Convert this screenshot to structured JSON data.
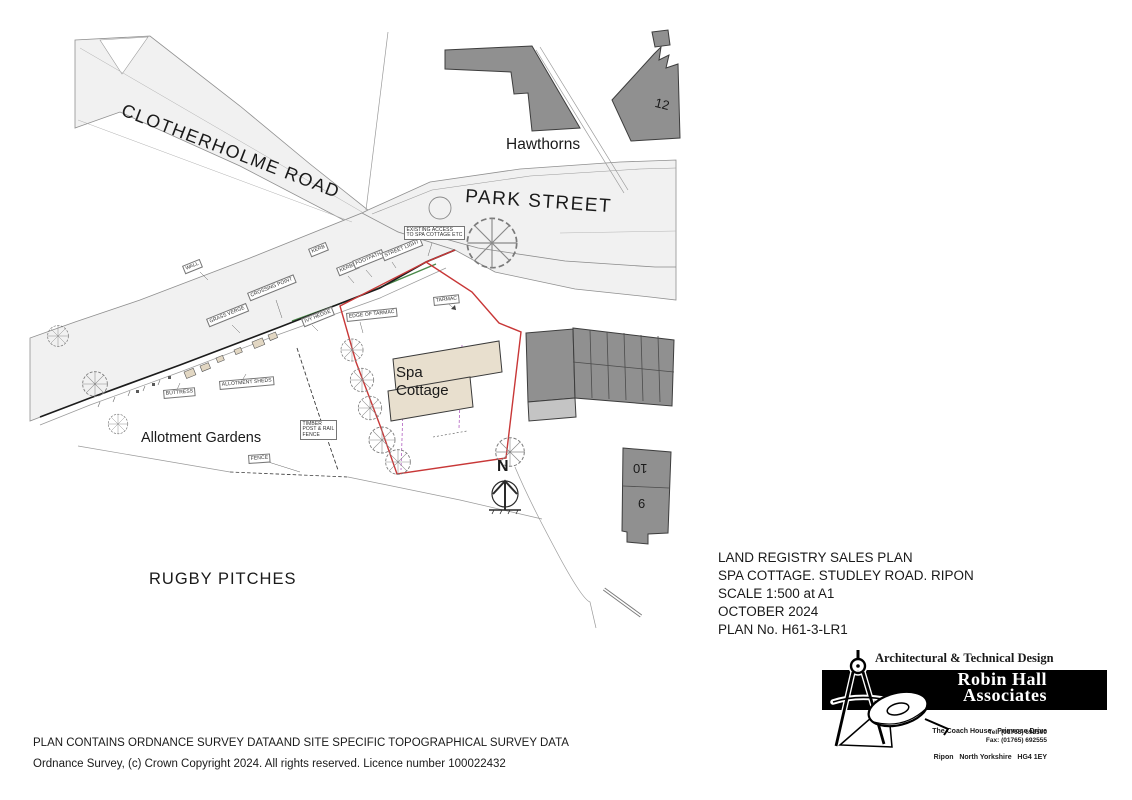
{
  "title_block": {
    "line1": "LAND REGISTRY SALES PLAN",
    "line2": "SPA COTTAGE. STUDLEY ROAD. RIPON",
    "line3": "SCALE 1:500 at A1",
    "line4": "OCTOBER 2024",
    "line5": "PLAN No. H61-3-LR1"
  },
  "footer": {
    "line1": "PLAN CONTAINS ORDNANCE SURVEY DATAAND SITE SPECIFIC TOPOGRAPHICAL SURVEY DATA",
    "line2": "Ordnance Survey, (c) Crown Copyright 2024. All rights reserved. Licence number 100022432"
  },
  "logo": {
    "tagline": "Architectural & Technical Design",
    "name_line1": "Robin Hall",
    "name_line2": "Associates",
    "address_line1": "The Coach House   Primrose Drive",
    "address_line2": "Ripon   North Yorkshire   HG4 1EY",
    "tel": "Tel: (01765) 692500",
    "fax": "Fax: (01765) 692555"
  },
  "map": {
    "streets": {
      "clotherholme_road": "CLOTHERHOLME ROAD",
      "park_street": "PARK STREET"
    },
    "areas": {
      "hawthorns": "Hawthorns",
      "allotment_gardens": "Allotment Gardens",
      "rugby_pitches": "RUGBY PITCHES"
    },
    "site": {
      "name_line1": "Spa",
      "name_line2": "Cottage"
    },
    "buildings": {
      "no12": "12",
      "no10": "10",
      "no9": "9"
    },
    "north_label": "N",
    "annotations": {
      "wall": "WALL",
      "kerb": "KERB",
      "kerbs": "KERBS",
      "footpath": "FOOTPATH",
      "street_light": "STREET LIGHT",
      "existing_access": "EXISTING ACCESS\nTO SPA COTTAGE ETC",
      "crossing_point": "CROSSING POINT",
      "grass_verge": "GRASS VERGE",
      "ivy_hedge": "IVY HEDGE",
      "edge_of_tarmac": "EDGE OF TARMAC",
      "tarmac": "TARMAC",
      "allotment_sheds": "ALLOTMENT SHEDS",
      "buttress": "BUTTRESS",
      "timber_fence": "TIMBER\nPOST & RAIL\nFENCE",
      "fence": "FENCE"
    },
    "colors": {
      "site_boundary": "#c83737",
      "building_fill": "#909090",
      "cottage_fill": "#e8dfce",
      "road_fill": "#f1f1f1",
      "hedge_green": "#4a8a4a",
      "services_magenta": "#b05fc0"
    }
  }
}
